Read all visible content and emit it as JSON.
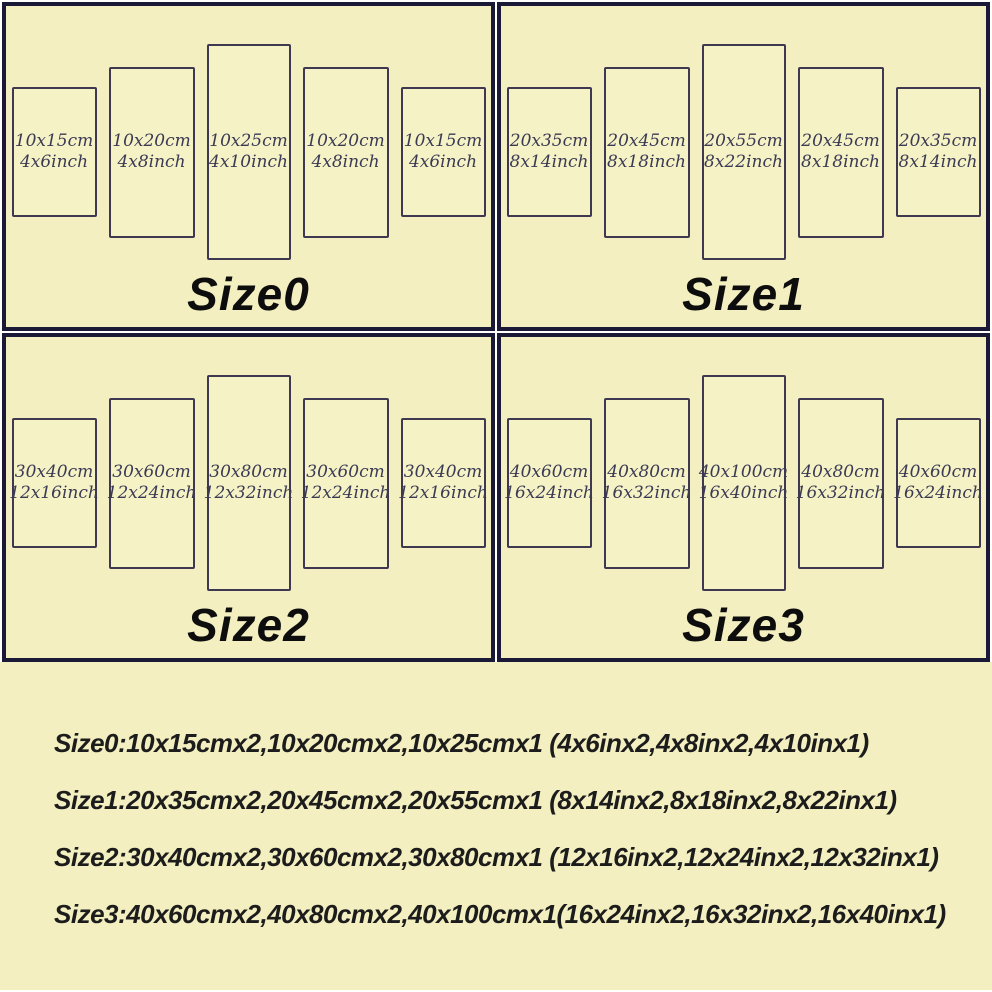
{
  "colors": {
    "background": "#f3efc0",
    "quadrant_border": "#1a1a36",
    "panel_border": "#3e3850",
    "panel_text": "#3b3a54",
    "label_text": "#0d0d0d",
    "summary_text": "#1c1c1c",
    "gap": "#ffffff"
  },
  "quadrants": [
    {
      "label": "Size0",
      "panels": [
        {
          "cm": "10x15cm",
          "inch": "4x6inch"
        },
        {
          "cm": "10x20cm",
          "inch": "4x8inch"
        },
        {
          "cm": "10x25cm",
          "inch": "4x10inch"
        },
        {
          "cm": "10x20cm",
          "inch": "4x8inch"
        },
        {
          "cm": "10x15cm",
          "inch": "4x6inch"
        }
      ]
    },
    {
      "label": "Size1",
      "panels": [
        {
          "cm": "20x35cm",
          "inch": "8x14inch"
        },
        {
          "cm": "20x45cm",
          "inch": "8x18inch"
        },
        {
          "cm": "20x55cm",
          "inch": "8x22inch"
        },
        {
          "cm": "20x45cm",
          "inch": "8x18inch"
        },
        {
          "cm": "20x35cm",
          "inch": "8x14inch"
        }
      ]
    },
    {
      "label": "Size2",
      "panels": [
        {
          "cm": "30x40cm",
          "inch": "12x16inch"
        },
        {
          "cm": "30x60cm",
          "inch": "12x24inch"
        },
        {
          "cm": "30x80cm",
          "inch": "12x32inch"
        },
        {
          "cm": "30x60cm",
          "inch": "12x24inch"
        },
        {
          "cm": "30x40cm",
          "inch": "12x16inch"
        }
      ]
    },
    {
      "label": "Size3",
      "panels": [
        {
          "cm": "40x60cm",
          "inch": "16x24inch"
        },
        {
          "cm": "40x80cm",
          "inch": "16x32inch"
        },
        {
          "cm": "40x100cm",
          "inch": "16x40inch"
        },
        {
          "cm": "40x80cm",
          "inch": "16x32inch"
        },
        {
          "cm": "40x60cm",
          "inch": "16x24inch"
        }
      ]
    }
  ],
  "summary": {
    "lines": [
      "Size0:10x15cmx2,10x20cmx2,10x25cmx1 (4x6inx2,4x8inx2,4x10inx1)",
      "Size1:20x35cmx2,20x45cmx2,20x55cmx1 (8x14inx2,8x18inx2,8x22inx1)",
      "Size2:30x40cmx2,30x60cmx2,30x80cmx1 (12x16inx2,12x24inx2,12x32inx1)",
      "Size3:40x60cmx2,40x80cmx2,40x100cmx1(16x24inx2,16x32inx2,16x40inx1)"
    ]
  }
}
